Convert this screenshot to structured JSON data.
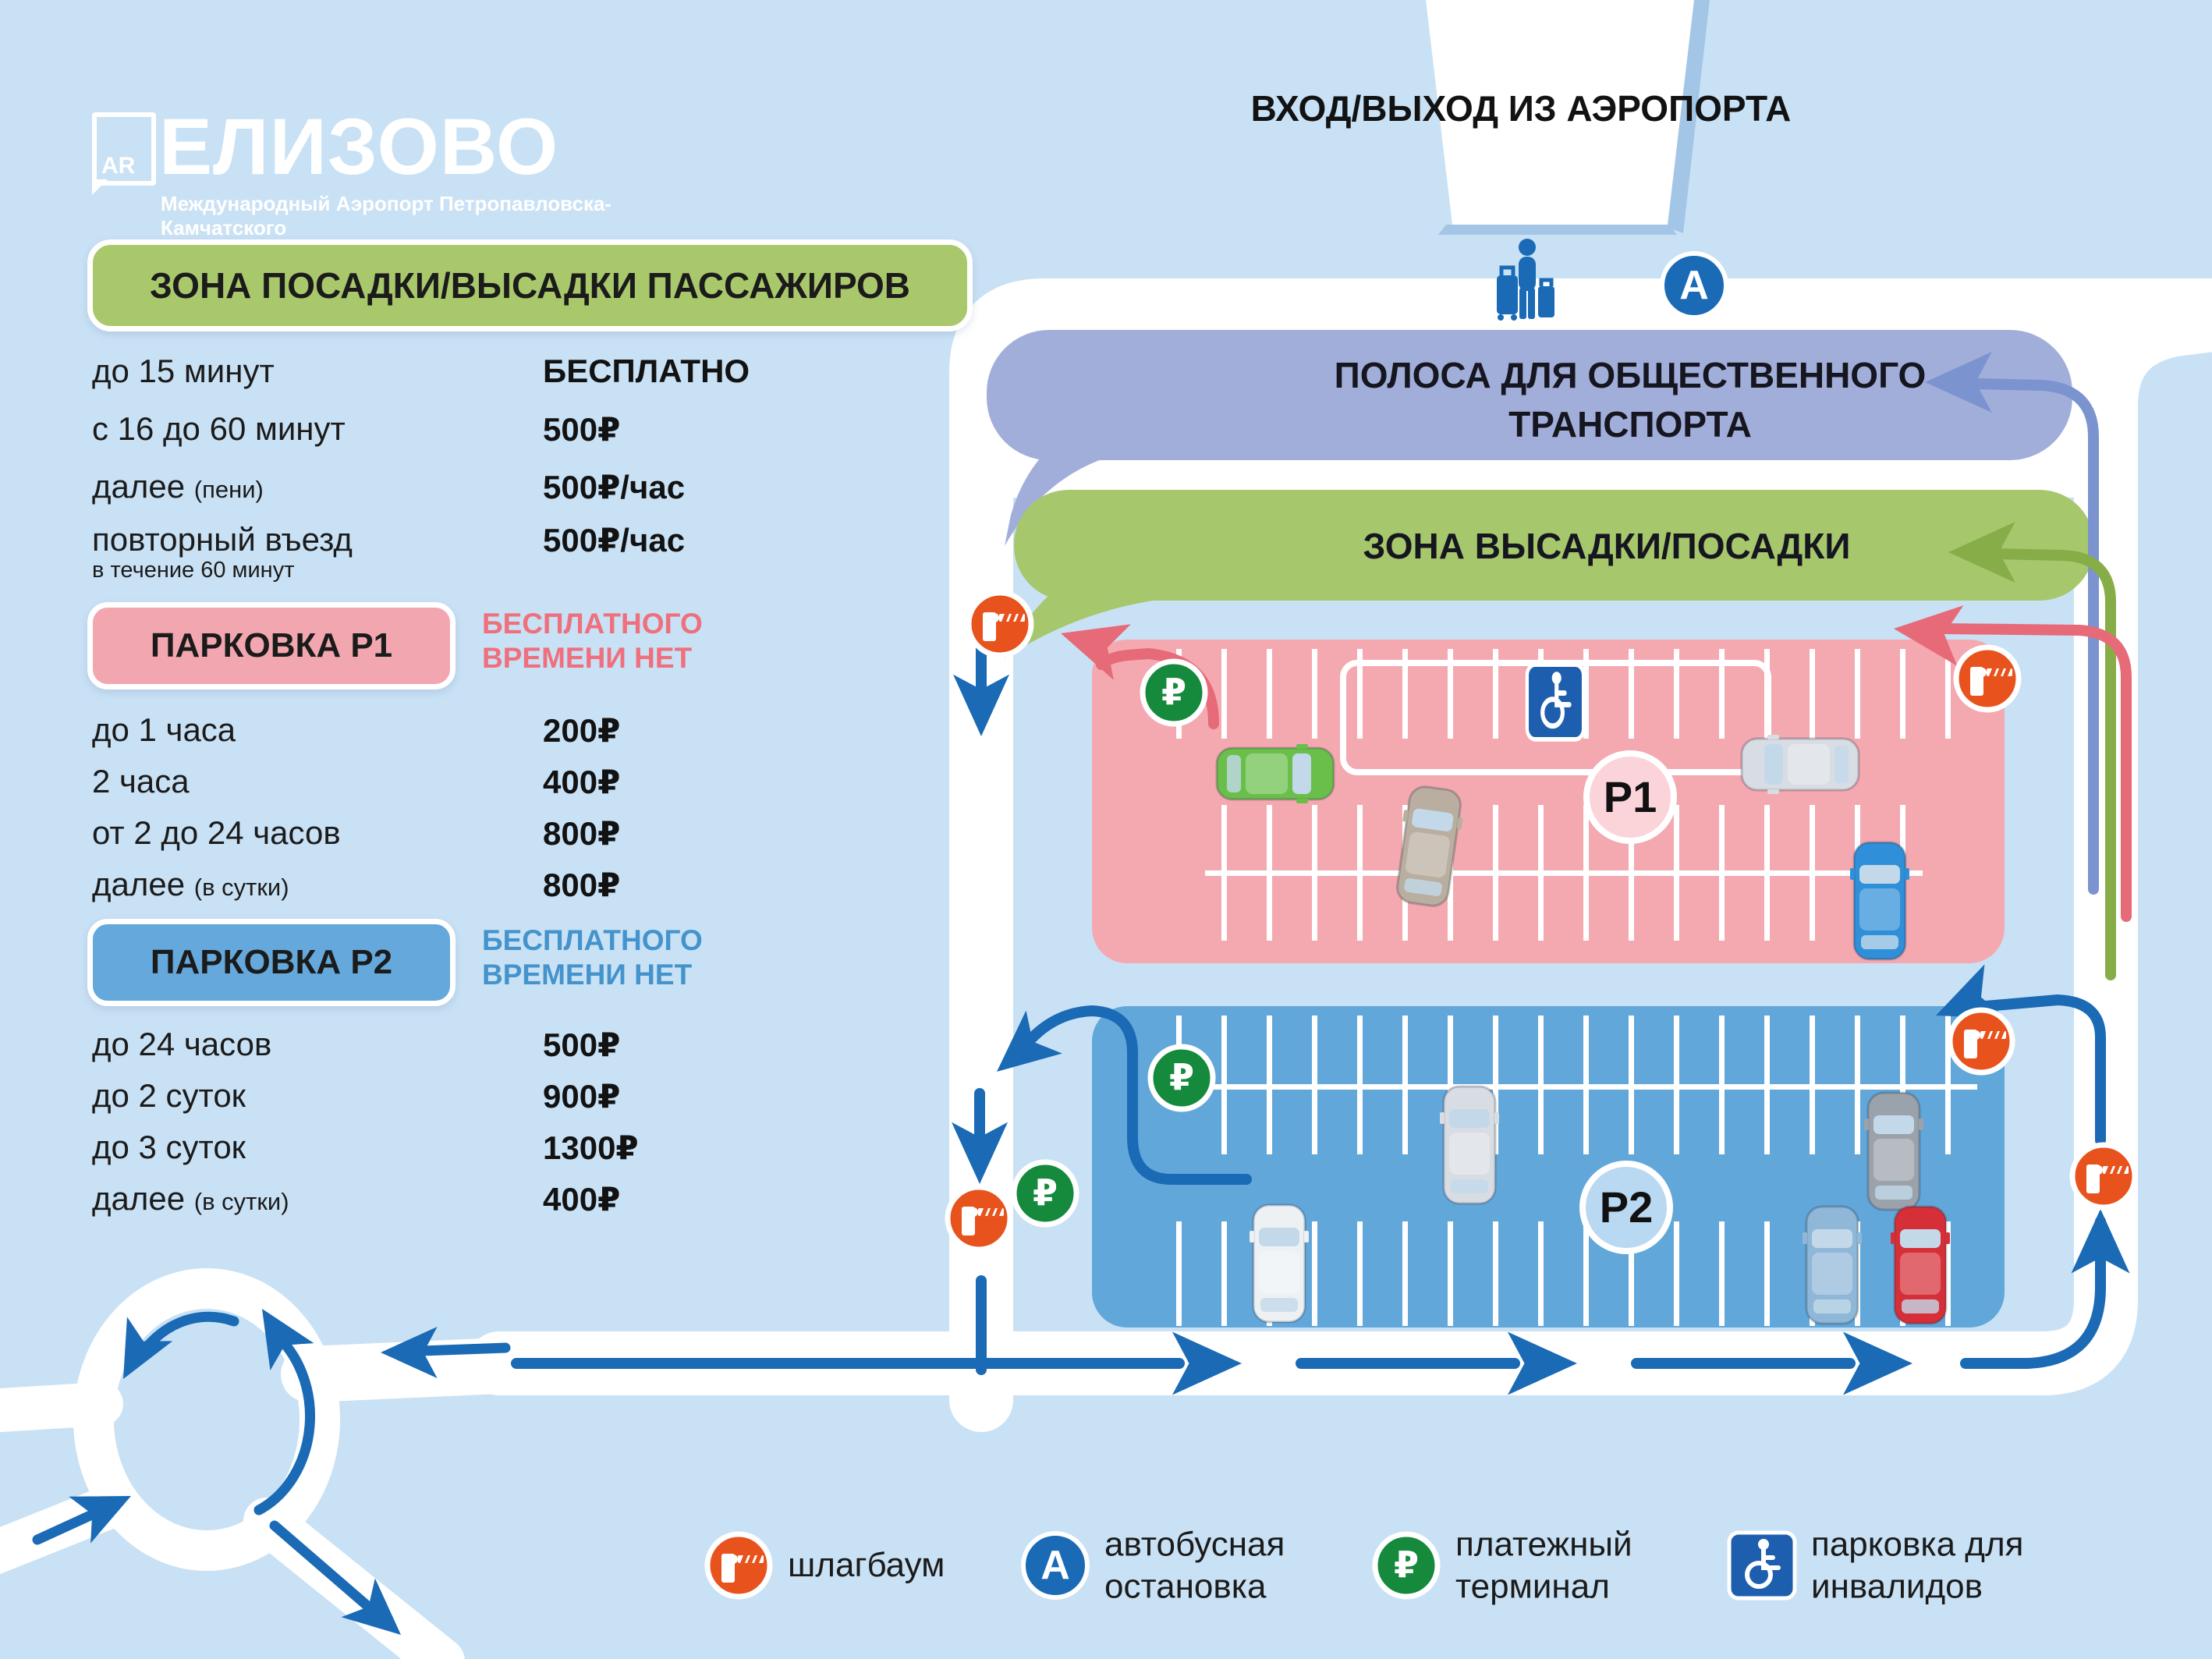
{
  "logo": {
    "code": "AR",
    "name": "ЕЛИЗОВО",
    "subtitle": "Международный Аэропорт Петропавловска-Камчатского"
  },
  "pricing": {
    "dropoff": {
      "title": "ЗОНА ПОСАДКИ/ВЫСАДКИ ПАССАЖИРОВ",
      "rows": [
        {
          "label": "до 15 минут",
          "note": "",
          "value": "БЕСПЛАТНО"
        },
        {
          "label": "с 16 до 60 минут",
          "note": "",
          "value": "500₽"
        },
        {
          "label": "далее",
          "note": "(пени)",
          "value": "500₽/час"
        },
        {
          "label": "повторный въезд",
          "sublabel": "в течение 60 минут",
          "value": "500₽/час"
        }
      ]
    },
    "p1": {
      "title": "ПАРКОВКА P1",
      "free_note": "БЕСПЛАТНОГО ВРЕМЕНИ НЕТ",
      "rows": [
        {
          "label": "до 1 часа",
          "note": "",
          "value": "200₽"
        },
        {
          "label": "2 часа",
          "note": "",
          "value": "400₽"
        },
        {
          "label": "от 2 до 24 часов",
          "note": "",
          "value": "800₽"
        },
        {
          "label": "далее",
          "note": "(в сутки)",
          "value": "800₽"
        }
      ]
    },
    "p2": {
      "title": "ПАРКОВКА P2",
      "free_note": "БЕСПЛАТНОГО ВРЕМЕНИ НЕТ",
      "rows": [
        {
          "label": "до 24 часов",
          "note": "",
          "value": "500₽"
        },
        {
          "label": "до 2 суток",
          "note": "",
          "value": "900₽"
        },
        {
          "label": "до 3 суток",
          "note": "",
          "value": "1300₽"
        },
        {
          "label": "далее",
          "note": "(в сутки)",
          "value": "400₽"
        }
      ]
    }
  },
  "map": {
    "entrance_label": "ВХОД/ВЫХОД ИЗ АЭРОПОРТА",
    "bus_lane_line1": "ПОЛОСА ДЛЯ ОБЩЕСТВЕННОГО",
    "bus_lane_line2": "ТРАНСПОРТА",
    "dropoff_zone_label": "ЗОНА ВЫСАДКИ/ПОСАДКИ",
    "p1_badge": "P1",
    "p2_badge": "P2",
    "bus_stop_letter": "A",
    "ruble_sign": "₽"
  },
  "legend": {
    "items": [
      {
        "icon": "barrier-icon",
        "label": "шлагбаум"
      },
      {
        "icon": "bus-stop-icon",
        "label": "автобусная остановка"
      },
      {
        "icon": "payment-terminal-icon",
        "label": "платежный терминал"
      },
      {
        "icon": "disabled-parking-icon",
        "label": "парковка для инвалидов"
      }
    ]
  },
  "colors": {
    "background": "#c9e1f5",
    "road": "#ffffff",
    "bus_lane_purple": "#a2aeda",
    "dropoff_green": "#a6c76c",
    "p1_pink": "#f4a9b1",
    "p2_blue": "#62a7da",
    "arrow_blue": "#1a6ab5",
    "terminal_green": "#15893c",
    "barrier_orange": "#e8531d",
    "p1_red_arrow": "#e66a78",
    "p1_note_pink": "#ef6f7d",
    "p2_note_blue": "#4593cd"
  }
}
